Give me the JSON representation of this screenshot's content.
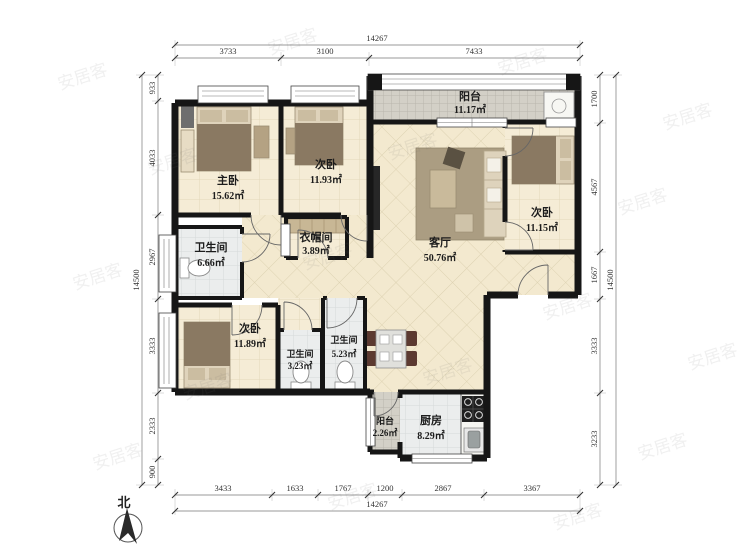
{
  "plan": {
    "compass_label": "北",
    "watermark": "安居客",
    "rooms": [
      {
        "id": "balcony-top",
        "name": "阳台",
        "area": "11.17㎡"
      },
      {
        "id": "master-bedroom",
        "name": "主卧",
        "area": "15.62㎡"
      },
      {
        "id": "bedroom-2",
        "name": "次卧",
        "area": "11.93㎡"
      },
      {
        "id": "cloakroom",
        "name": "衣帽间",
        "area": "3.89㎡"
      },
      {
        "id": "bathroom-1",
        "name": "卫生间",
        "area": "6.66㎡"
      },
      {
        "id": "bedroom-3",
        "name": "次卧",
        "area": "11.15㎡"
      },
      {
        "id": "living-room",
        "name": "客厅",
        "area": "50.76㎡"
      },
      {
        "id": "bedroom-4",
        "name": "次卧",
        "area": "11.89㎡"
      },
      {
        "id": "bathroom-2",
        "name": "卫生间",
        "area": "3.23㎡"
      },
      {
        "id": "bathroom-3",
        "name": "卫生间",
        "area": "5.23㎡"
      },
      {
        "id": "balcony-bottom",
        "name": "阳台",
        "area": "2.26㎡"
      },
      {
        "id": "kitchen",
        "name": "厨房",
        "area": "8.29㎡"
      }
    ],
    "dimensions": {
      "top": {
        "total": "14267",
        "segments": [
          "3733",
          "3100",
          "7433"
        ]
      },
      "bottom": {
        "total": "14267",
        "segments": [
          "3433",
          "1633",
          "1767",
          "1200",
          "2867",
          "3367"
        ]
      },
      "left": {
        "total": "14500",
        "segments": [
          "933",
          "4033",
          "2967",
          "3333",
          "2333",
          "900"
        ]
      },
      "right": {
        "total": "14500",
        "segments": [
          "1700",
          "4567",
          "1667",
          "3333",
          "3233"
        ]
      }
    },
    "colors": {
      "wall": "#161616",
      "floor_cream": "#f4ead3",
      "floor_balcony": "#d3d0c7",
      "floor_bath": "#ebeded",
      "dim_text": "#333333"
    }
  }
}
